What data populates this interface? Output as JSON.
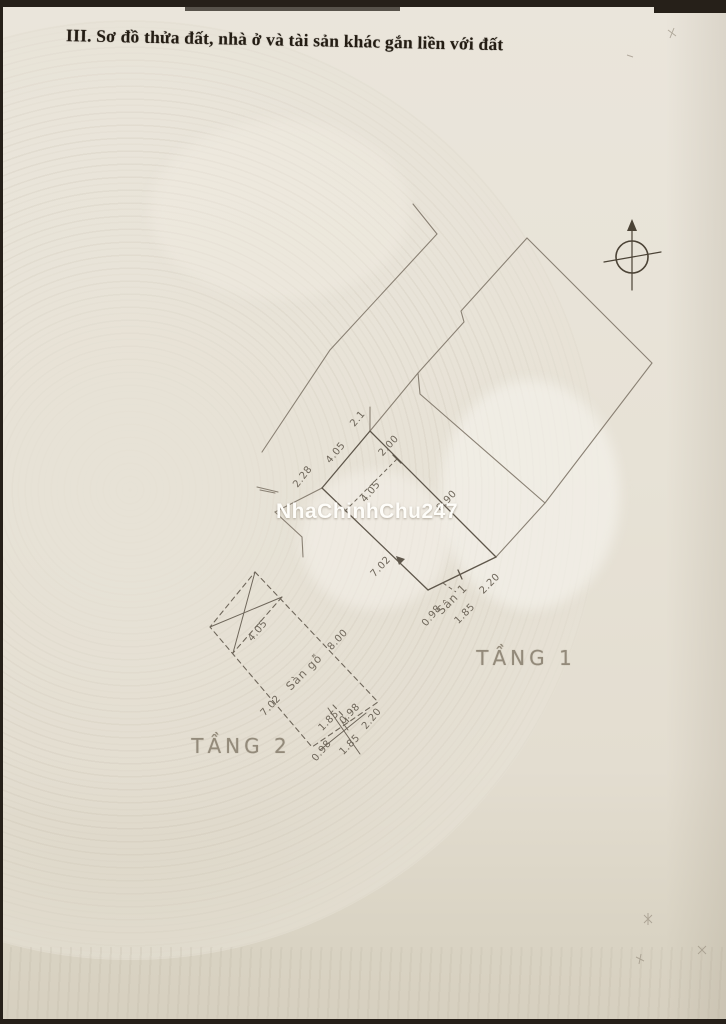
{
  "page": {
    "title": "III. Sơ đồ thửa đất, nhà ở và tài sản khác gắn liền với đất"
  },
  "watermark": {
    "text": "NhaChinhChu247"
  },
  "icons": {
    "north": "north-arrow-icon"
  },
  "diagram": {
    "floor1": {
      "name": "TẦNG 1",
      "area_label": "Sân 1",
      "dims": {
        "d21": "2.1",
        "d200": "2.00",
        "d405a": "4.05",
        "d228": "2.28",
        "d405b": "4.05",
        "d890": "8.90",
        "d702": "7.02",
        "d098": "0.98",
        "d185": "1.85",
        "d220": "2.20"
      }
    },
    "floor2": {
      "name": "TẦNG 2",
      "area_label": "Sàn gỗ",
      "dims": {
        "d405": "4.05",
        "d800": "8.00",
        "d702": "7.02",
        "d185a": "1.85",
        "d098a": "0.98",
        "d220": "2.20",
        "d098b": "0.98",
        "d185b": "1.85"
      }
    }
  }
}
